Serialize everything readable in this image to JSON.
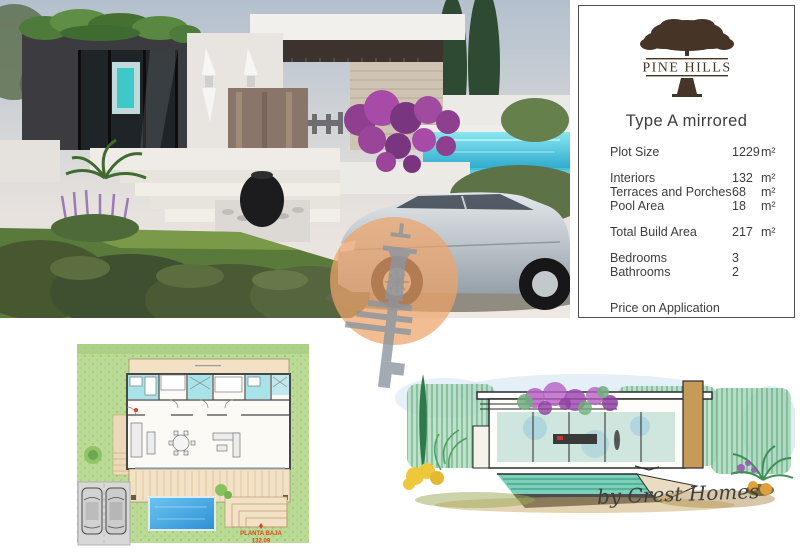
{
  "brand": {
    "logo_text": "PINE HILLS",
    "credit": "by Crest Homes"
  },
  "panel": {
    "title": "Type A mirrored",
    "rows": [
      {
        "label": "Plot Size",
        "value": "1229",
        "unit": "m²"
      },
      {
        "label": "Interiors",
        "value": "132",
        "unit": "m²"
      },
      {
        "label": "Terraces and Porches",
        "value": "68",
        "unit": "m²"
      },
      {
        "label": "Pool Area",
        "value": "18",
        "unit": "m²"
      },
      {
        "label": "Total Build Area",
        "value": "217",
        "unit": "m²"
      },
      {
        "label": "Bedrooms",
        "value": "3",
        "unit": ""
      },
      {
        "label": "Bathrooms",
        "value": "2",
        "unit": ""
      }
    ],
    "price_note": "Price on Application"
  },
  "floorplan": {
    "plan_label": "PLANTA BAJA",
    "plan_area": "132.09"
  },
  "icons": {
    "logo_tree": "pine-tree-icon",
    "watermark": "tower-key-icon"
  },
  "colors": {
    "panel_text": "#3d3d3d",
    "logo_brown": "#463526",
    "plan_label_red": "#e0481f",
    "watermark_orange": "#eea46a",
    "pool_blue": "#36b0d8",
    "lawn_green": "#bada95"
  }
}
